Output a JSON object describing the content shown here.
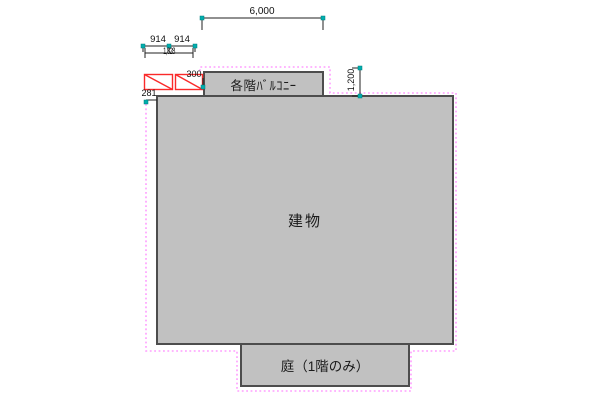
{
  "drawing": {
    "labels": {
      "building": "建物",
      "balcony": "各階ﾊﾞﾙｺﾆｰ",
      "garden": "庭（1階のみ）"
    },
    "dimensions": {
      "balcony_width": "6,000",
      "left_segment_a": "914",
      "left_segment_b": "914",
      "left_total": "1,828",
      "balcony_side_offset": "300",
      "left_edge_offset": "281",
      "balcony_depth": "1,200"
    },
    "colors": {
      "shape_fill": "#c1c1c1",
      "shape_border": "#4d4d4d",
      "offset_boundary": "#ff9dff",
      "hatch_red": "#fa2a2a",
      "grip_handle": "#00aeae",
      "dimension_line": "#222222"
    }
  }
}
